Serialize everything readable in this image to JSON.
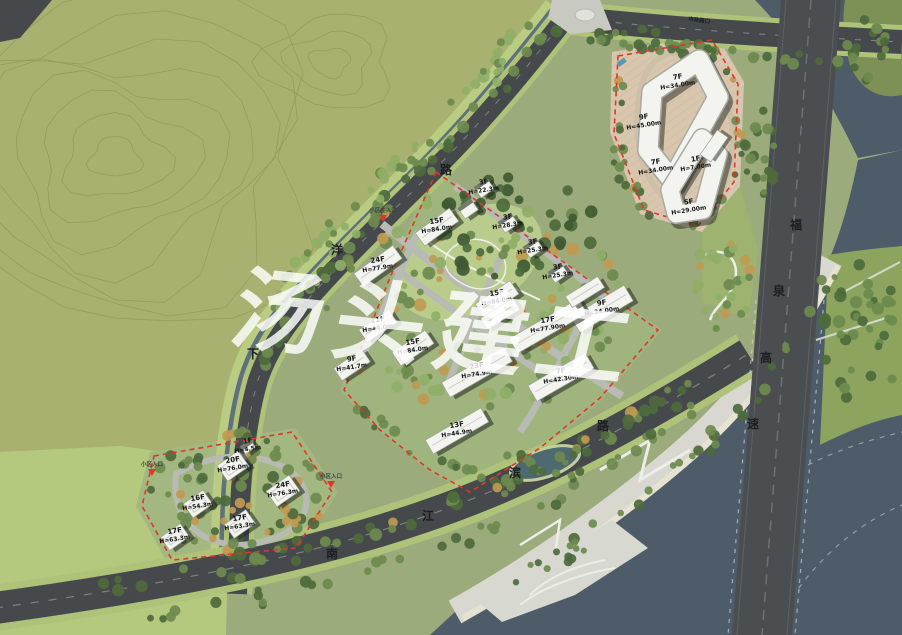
{
  "palette": {
    "base": "#9cab7c",
    "hill": "#a8b170",
    "contour": "#8e9a58",
    "flat": "#b5c97e",
    "parcel": "#a0b47e",
    "parcel2": "#a3b780",
    "meadow": "#b9cc8b",
    "tan": "#d8c6ae",
    "road_dark": "#46494b",
    "road_verge": "#aec27a",
    "canal": "#5e7079",
    "river": "#4d5c68",
    "pond": "#4e6a70",
    "island": "#7d9055",
    "eastband": "#8ca45e",
    "promenade": "#d8d8d0",
    "sand": "#e8e4d0",
    "tree_dark": "#4d6a3c",
    "tree_dark2": "#3f5a33",
    "tree_mid": "#6d8a4f",
    "tree_light": "#8fae67",
    "tree_orange": "#c09a52",
    "building": "#f3f4f0",
    "building_stroke": "#9fa39b",
    "shadow": "rgba(32,38,30,0.55)",
    "red": "#e0362b",
    "label": "#141516",
    "road_char": "#1c1e20",
    "watermark_fill": "rgba(255,255,255,0.82)"
  },
  "watermark": {
    "text": "汤头建工"
  },
  "roads": {
    "names": [
      {
        "name": "下洋路",
        "chars": [
          {
            "ch": "下",
            "x": 253,
            "y": 358
          },
          {
            "ch": "洋",
            "x": 337,
            "y": 254
          },
          {
            "ch": "路",
            "x": 446,
            "y": 174
          }
        ]
      },
      {
        "name": "南江滨路",
        "chars": [
          {
            "ch": "南",
            "x": 332,
            "y": 558
          },
          {
            "ch": "江",
            "x": 428,
            "y": 520
          },
          {
            "ch": "滨",
            "x": 515,
            "y": 477
          },
          {
            "ch": "路",
            "x": 603,
            "y": 430
          }
        ]
      },
      {
        "name": "福泉高速",
        "chars": [
          {
            "ch": "福",
            "x": 796,
            "y": 229
          },
          {
            "ch": "泉",
            "x": 779,
            "y": 295
          },
          {
            "ch": "高",
            "x": 766,
            "y": 362
          },
          {
            "ch": "速",
            "x": 753,
            "y": 428
          }
        ]
      }
    ]
  },
  "buildings": [
    {
      "x": 678,
      "y": 80,
      "floors": "7F",
      "height": "H=34.00m"
    },
    {
      "x": 644,
      "y": 120,
      "floors": "9F",
      "height": "H=45.00m"
    },
    {
      "x": 656,
      "y": 165,
      "floors": "7F",
      "height": "H=34.00m"
    },
    {
      "x": 696,
      "y": 162,
      "floors": "1F",
      "height": "H=7.00m"
    },
    {
      "x": 689,
      "y": 205,
      "floors": "5F",
      "height": "H=29.00m"
    },
    {
      "x": 484,
      "y": 185,
      "floors": "3F",
      "height": "H=22.3m"
    },
    {
      "x": 508,
      "y": 220,
      "floors": "3F",
      "height": "H=28.3m"
    },
    {
      "x": 533,
      "y": 245,
      "floors": "3F",
      "height": "H=25.3m"
    },
    {
      "x": 558,
      "y": 270,
      "floors": "3F",
      "height": "H=25.3m"
    },
    {
      "x": 437,
      "y": 224,
      "floors": "15F",
      "height": "H=84.0m"
    },
    {
      "x": 378,
      "y": 263,
      "floors": "24F",
      "height": "H=77.9m"
    },
    {
      "x": 497,
      "y": 296,
      "floors": "15F",
      "height": "H=84.0m"
    },
    {
      "x": 413,
      "y": 345,
      "floors": "15F",
      "height": "H=84.0m"
    },
    {
      "x": 378,
      "y": 323,
      "floors": "11F",
      "height": "H=44.0m"
    },
    {
      "x": 352,
      "y": 362,
      "floors": "9F",
      "height": "H=41.7m"
    },
    {
      "x": 602,
      "y": 306,
      "floors": "9F",
      "height": "H=34.00m"
    },
    {
      "x": 548,
      "y": 323,
      "floors": "17F",
      "height": "H=77.90m"
    },
    {
      "x": 561,
      "y": 374,
      "floors": "7F",
      "height": "H=42.30m"
    },
    {
      "x": 477,
      "y": 369,
      "floors": "23F",
      "height": "H=74.9m"
    },
    {
      "x": 457,
      "y": 428,
      "floors": "13F",
      "height": "H=44.9m"
    },
    {
      "x": 248,
      "y": 444,
      "floors": "1F",
      "height": "H=4.5m"
    },
    {
      "x": 233,
      "y": 463,
      "floors": "20F",
      "height": "H=76.0m"
    },
    {
      "x": 283,
      "y": 488,
      "floors": "24F",
      "height": "H=76.3m"
    },
    {
      "x": 198,
      "y": 501,
      "floors": "16F",
      "height": "H=54.3m"
    },
    {
      "x": 240,
      "y": 521,
      "floors": "17F",
      "height": "H=63.3m"
    },
    {
      "x": 175,
      "y": 534,
      "floors": "17F",
      "height": "H=63.3m"
    }
  ],
  "entrances": [
    {
      "label": "小区主入口",
      "x": 383,
      "y": 212
    },
    {
      "label": "小区入口",
      "x": 152,
      "y": 466
    },
    {
      "label": "小区入口",
      "x": 331,
      "y": 478
    }
  ],
  "misc_labels": [
    {
      "text": "市政路口",
      "x": 699,
      "y": 22,
      "rot": 8
    }
  ]
}
